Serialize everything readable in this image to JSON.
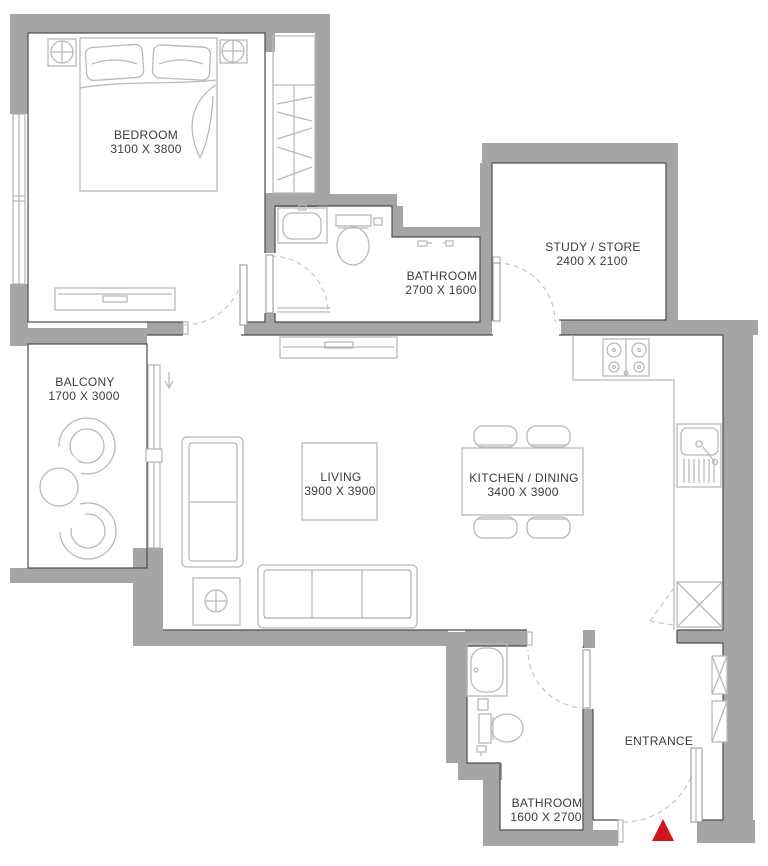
{
  "plan": {
    "title": "Apartment floor plan",
    "rooms": {
      "bedroom": {
        "name": "BEDROOM",
        "dims": "3100 X 3800"
      },
      "bathroom_top": {
        "name": "BATHROOM",
        "dims": "2700 X 1600"
      },
      "study": {
        "name": "STUDY / STORE",
        "dims": "2400 X 2100"
      },
      "balcony": {
        "name": "BALCONY",
        "dims": "1700 X 3000"
      },
      "living": {
        "name": "LIVING",
        "dims": "3900 X 3900"
      },
      "kitchen_dining": {
        "name": "KITCHEN / DINING",
        "dims": "3400 X 3900"
      },
      "bathroom_bottom": {
        "name": "BATHROOM",
        "dims": "1600 X 2700"
      },
      "entrance": {
        "name": "ENTRANCE"
      }
    },
    "colors": {
      "wall": "#a5a5a5",
      "outline": "#4d4d4d",
      "furniture": "#b9b9b9",
      "window": "#ababab",
      "door_arc": "#c9c9c9",
      "text": "#3b3b3b",
      "entrance_marker": "#d0151c"
    }
  }
}
